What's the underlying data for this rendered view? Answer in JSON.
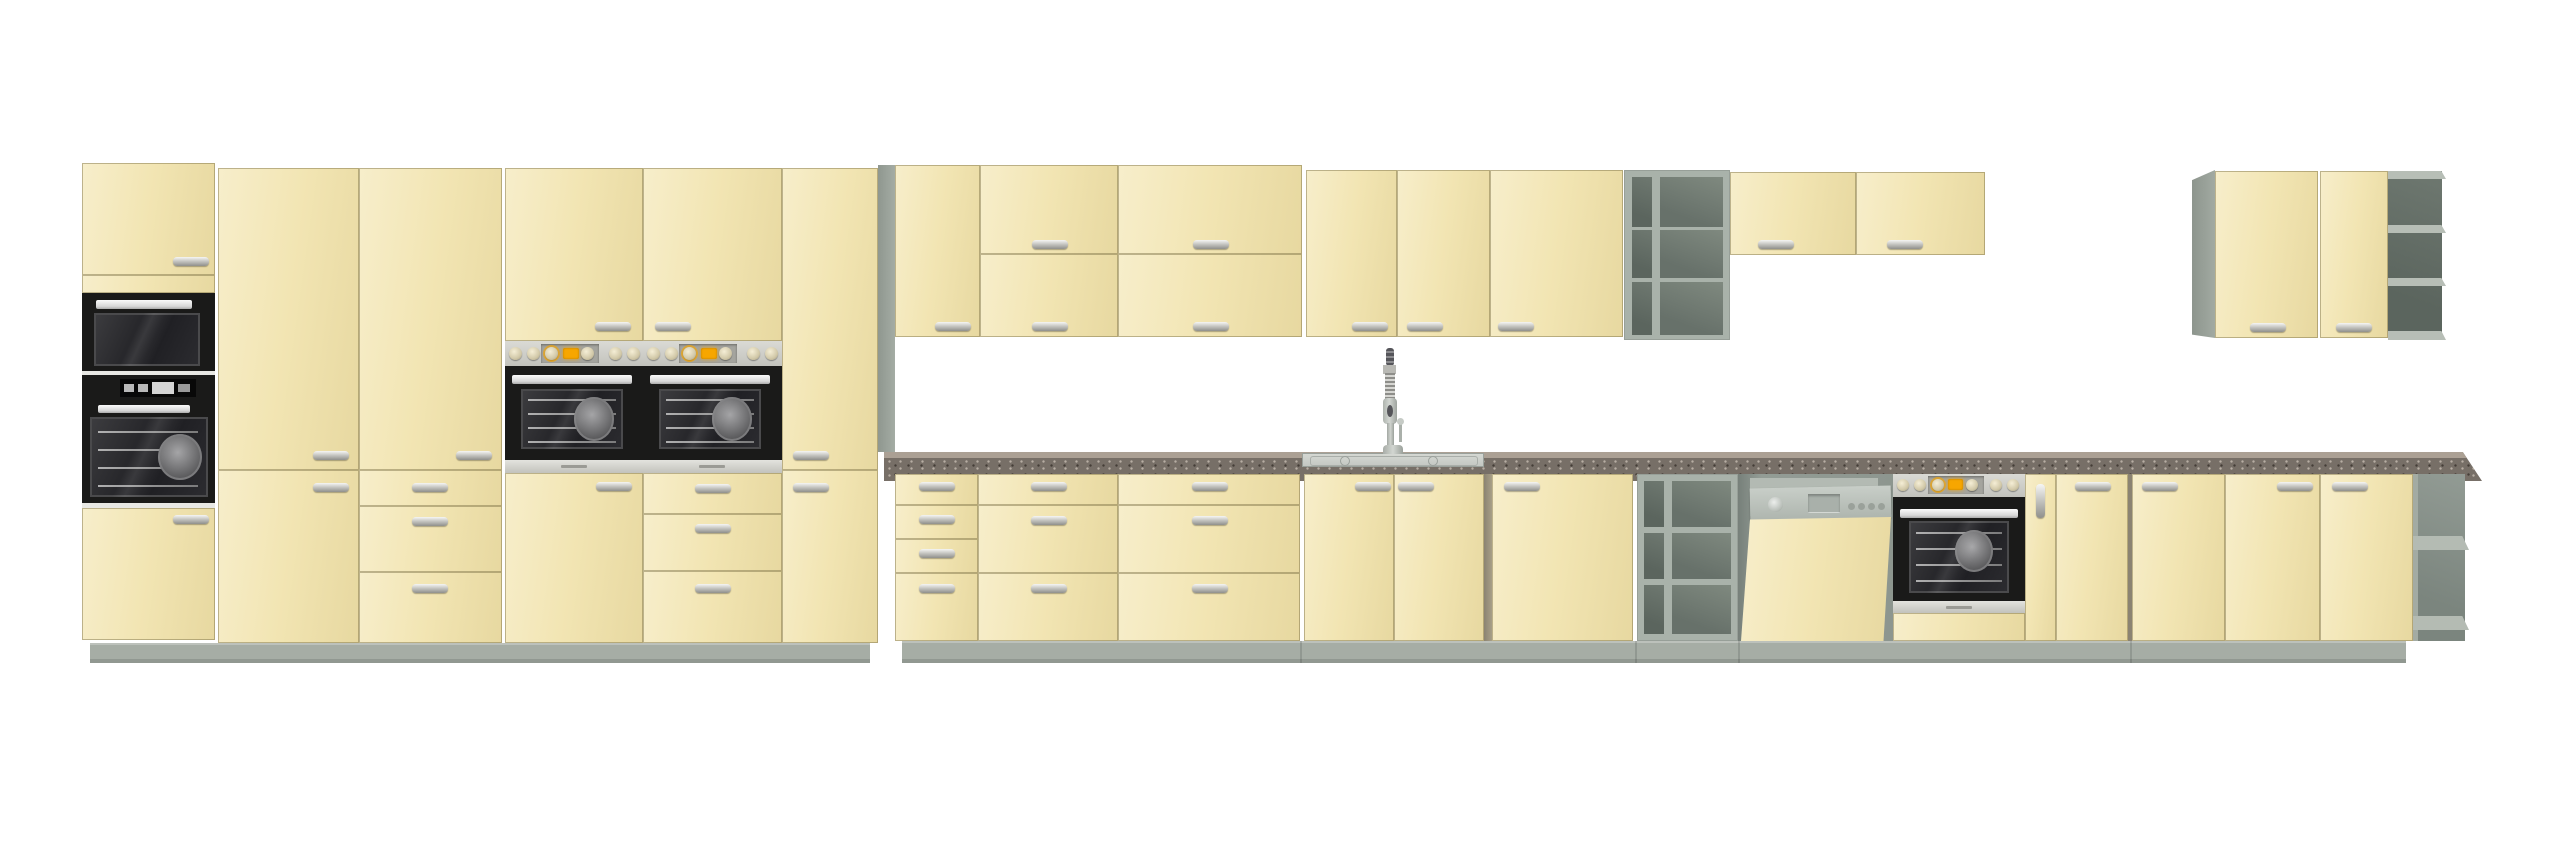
{
  "meta": {
    "description": "Product render of a cream/krem modular kitchen furniture set on white background",
    "canvas": {
      "width": 2560,
      "height": 847
    },
    "visible_text": []
  },
  "palette": {
    "cream": "#f2e5b3",
    "cream-hi": "#f7eecb",
    "cream-lo": "#e7d8a0",
    "gap-line": "rgba(118,106,64,0.45)",
    "carcass": "#9aa29a",
    "shelf-frame": "#a9b2aa",
    "cell-dark": "#5b655e",
    "cell-mid": "#6e7870",
    "plinth": "#a6ada5",
    "counter-face": "#776f67",
    "counter-top": "#aba094",
    "steel": "#c3c3bd",
    "steel-light": "#dadad5",
    "appliance-black": "#1a1a19",
    "display-orange": "#f7a600",
    "white-sep": "#e8e8e4"
  },
  "scene": {
    "sections": [
      {
        "name": "tall-housing-microwave-oven",
        "components": [
          "top-door",
          "built-in-microwave",
          "built-in-oven",
          "bottom-door"
        ]
      },
      {
        "name": "tall-pantry-two-door",
        "components": [
          "tall-door",
          "bottom-door"
        ]
      },
      {
        "name": "tall-pantry-with-drawers",
        "components": [
          "tall-door",
          "drawer",
          "drawer",
          "drawer"
        ]
      },
      {
        "name": "tall-oven-housing-1",
        "components": [
          "top-door",
          "oven-control-panel",
          "oven-door",
          "bottom-door"
        ]
      },
      {
        "name": "tall-oven-housing-2",
        "components": [
          "top-door",
          "oven-control-panel",
          "oven-door",
          "drawer",
          "drawer",
          "drawer"
        ]
      },
      {
        "name": "tall-pantry-narrow",
        "components": [
          "tall-door",
          "bottom-door"
        ]
      },
      {
        "name": "wall-cabinet-single-door",
        "components": [
          "door"
        ]
      },
      {
        "name": "wall-cabinet-double-flap-1",
        "components": [
          "flap-door-top",
          "flap-door-bottom"
        ]
      },
      {
        "name": "wall-cabinet-double-flap-2",
        "components": [
          "flap-door-top",
          "flap-door-bottom"
        ]
      },
      {
        "name": "wall-cabinet-two-door",
        "components": [
          "door-left",
          "door-right"
        ]
      },
      {
        "name": "wall-cabinet-wide-single-door",
        "components": [
          "door"
        ]
      },
      {
        "name": "wall-open-shelf-unit",
        "components": [
          "6 open cells (2 columns x 3 rows)"
        ]
      },
      {
        "name": "wall-flap-cabinet-short-1",
        "components": [
          "flap-door"
        ]
      },
      {
        "name": "wall-flap-cabinet-short-2",
        "components": [
          "flap-door"
        ]
      },
      {
        "name": "wall-corner-unit-right",
        "components": [
          "side-panel",
          "door",
          "door",
          "open-end-shelves"
        ]
      },
      {
        "name": "base-drawer-unit-4",
        "components": [
          "drawer",
          "drawer",
          "drawer",
          "drawer"
        ]
      },
      {
        "name": "base-drawer-unit-3a",
        "components": [
          "drawer",
          "drawer",
          "drawer"
        ]
      },
      {
        "name": "base-drawer-unit-3b",
        "components": [
          "drawer",
          "drawer",
          "drawer"
        ]
      },
      {
        "name": "base-sink-cabinet",
        "components": [
          "door-left",
          "door-right",
          "inset-sink",
          "pull-down-faucet"
        ]
      },
      {
        "name": "base-cabinet-wide-door",
        "components": [
          "door"
        ]
      },
      {
        "name": "base-open-shelf-unit",
        "components": [
          "6 open cells (2 columns x 3 rows)"
        ]
      },
      {
        "name": "dishwasher-semi-integrated",
        "components": [
          "control-strip",
          "tilted-front-panel"
        ]
      },
      {
        "name": "base-oven-housing",
        "components": [
          "oven-control-panel",
          "oven-door",
          "bottom-panel"
        ]
      },
      {
        "name": "base-filler-door-narrow",
        "components": [
          "door-vertical-handle"
        ]
      },
      {
        "name": "base-door-1",
        "components": [
          "door"
        ]
      },
      {
        "name": "base-door-2",
        "components": [
          "door"
        ]
      },
      {
        "name": "base-door-3",
        "components": [
          "door"
        ]
      },
      {
        "name": "base-door-4",
        "components": [
          "door"
        ]
      },
      {
        "name": "base-open-end-shelf-right",
        "components": [
          "2 open shelves"
        ]
      }
    ],
    "appliances": [
      "built-in microwave",
      "built-in oven (tall left)",
      "built-in oven x2 (tall columns)",
      "built-in oven (under counter)",
      "semi-integrated dishwasher (open)",
      "stainless inset sink",
      "pull-down spring faucet"
    ],
    "counts": {
      "handles_horizontal": 44,
      "handles_vertical": 1,
      "open_shelf_units": 4,
      "ovens": 4,
      "worktop_runs": 1
    }
  }
}
